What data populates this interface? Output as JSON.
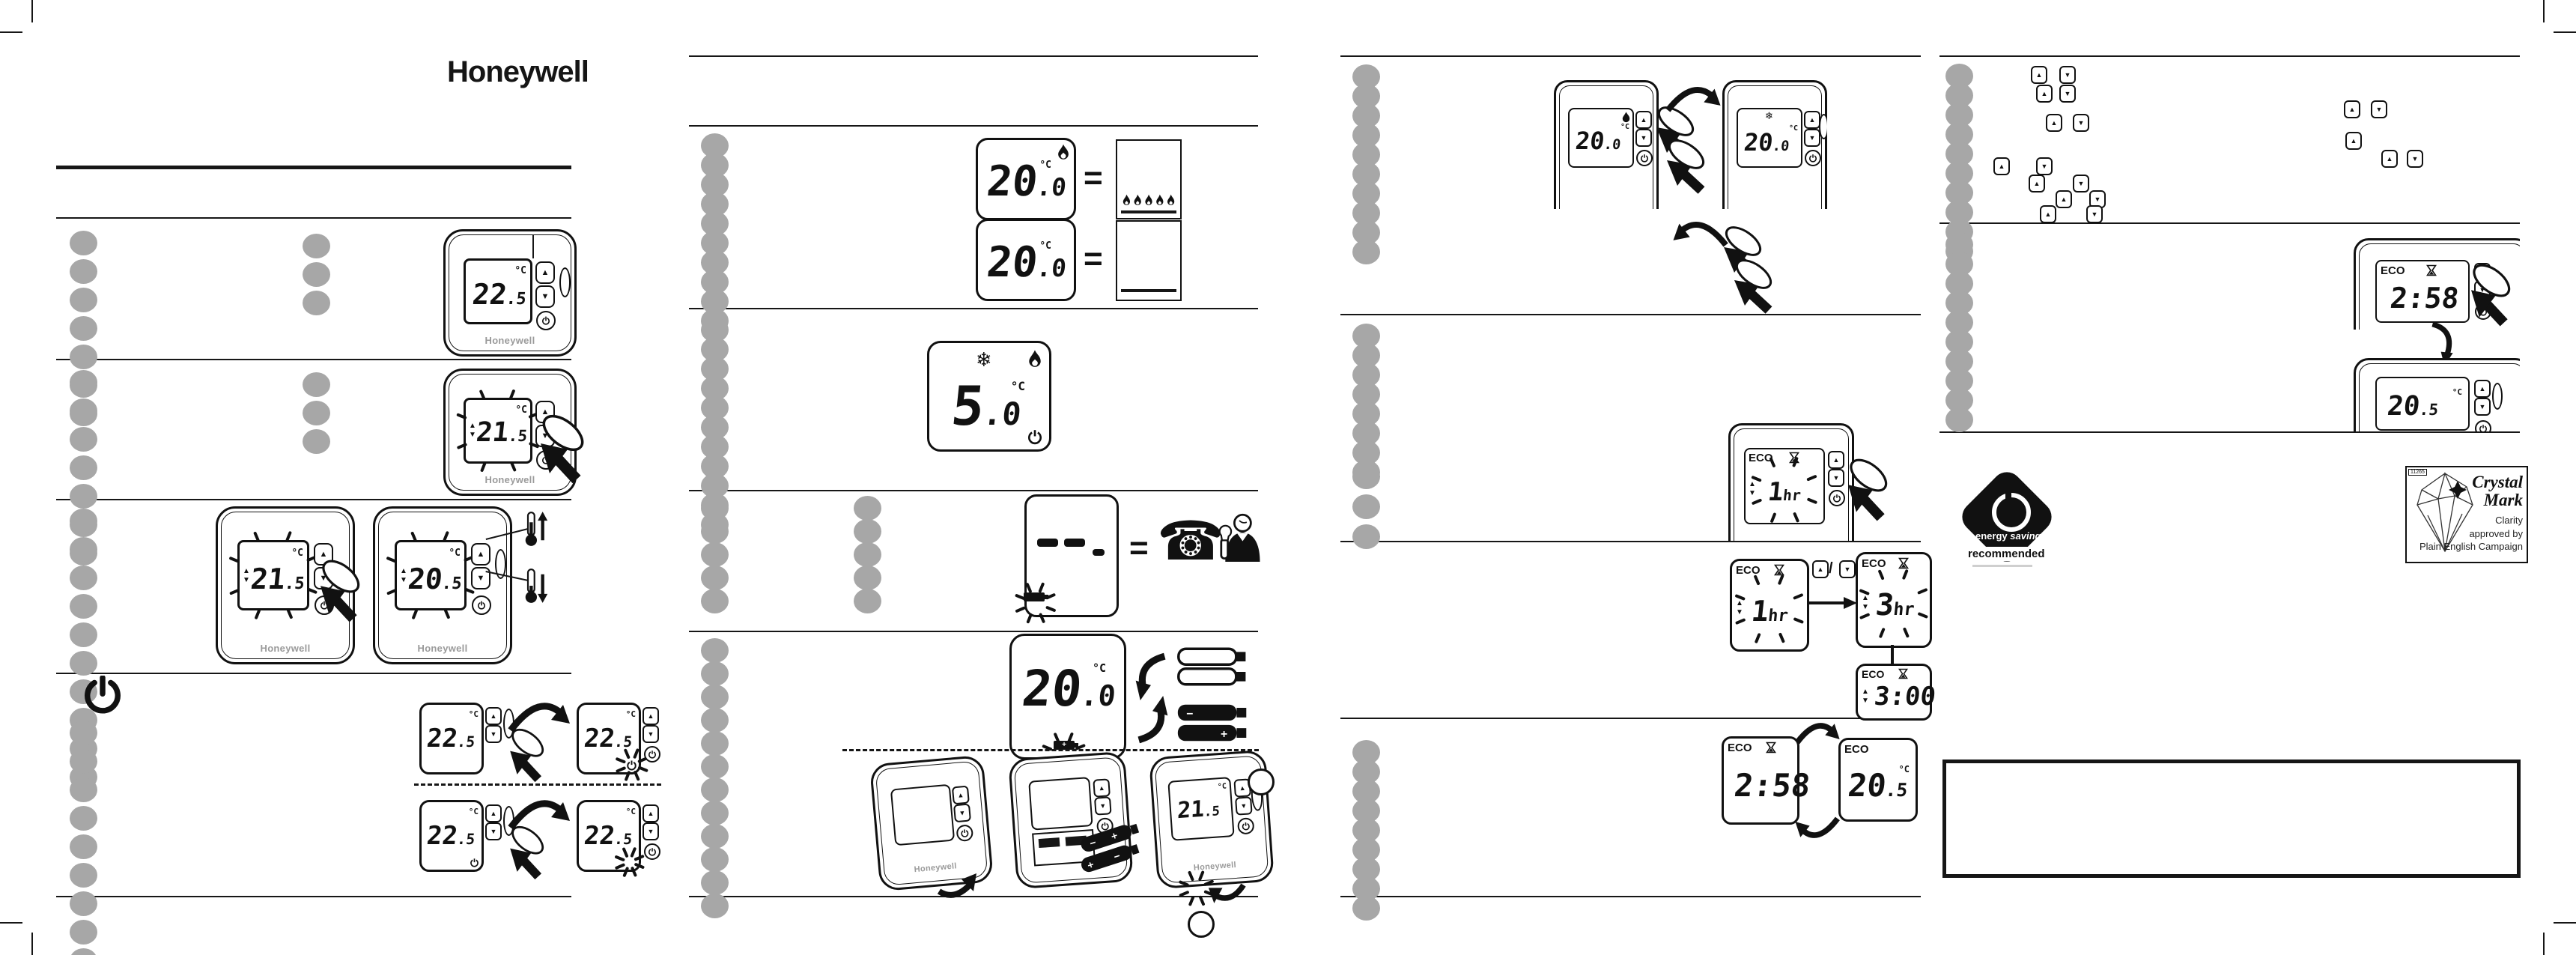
{
  "brand": {
    "logo": "Honeywell",
    "device_label": "Honeywell"
  },
  "colors": {
    "ink": "#111111",
    "redacted_gray": "#a7a7a7",
    "paper": "#ffffff"
  },
  "labels": {
    "eco": "ECO",
    "equals": "=",
    "slash": "/",
    "unit": "°C"
  },
  "icons": {
    "up_arrow": "▲",
    "down_arrow": "▼",
    "snowflake": "❄",
    "phone": "☎"
  },
  "displays": {
    "room": {
      "int": "22",
      "frac": ".5"
    },
    "adjust": {
      "int": "21",
      "frac": ".5"
    },
    "adjusted": {
      "int": "20",
      "frac": ".5"
    },
    "current": {
      "int": "20",
      "frac": ".0"
    },
    "frost": {
      "int": "5",
      "frac": ".0"
    },
    "eco_start": {
      "int": "1",
      "suffix": "hr"
    },
    "eco_set": {
      "int": "3",
      "suffix": "hr"
    },
    "eco_timer": "3:00",
    "eco_countdown": "2:58"
  },
  "logos": {
    "energy_saving": {
      "word1": "energy",
      "word2": "saving",
      "word3": "recommended"
    },
    "crystal_mark": {
      "ref": "11265",
      "name1": "Crystal",
      "name2": "Mark",
      "cap1": "Clarity",
      "cap2": "approved by",
      "cap3": "Plain English Campaign"
    }
  }
}
